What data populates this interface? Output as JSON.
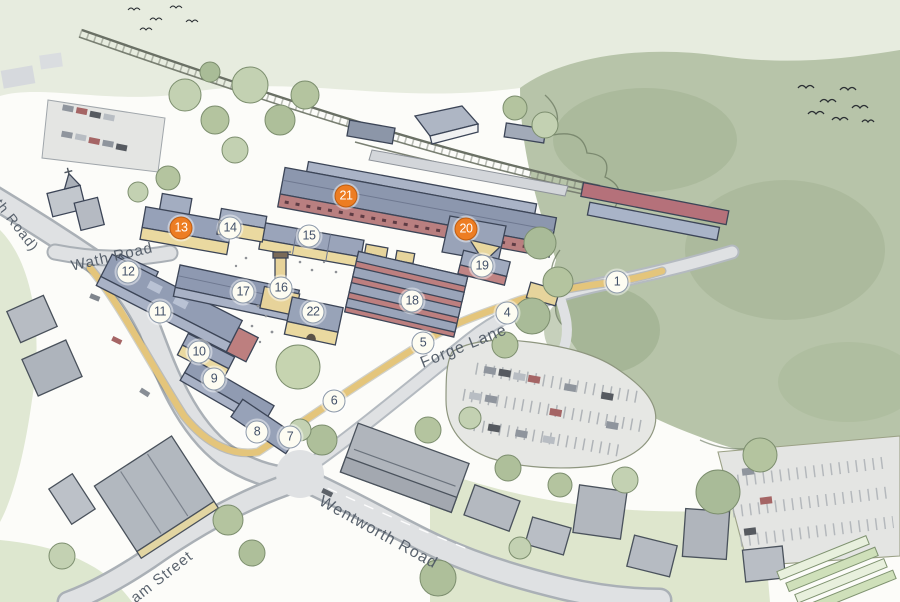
{
  "illustration": {
    "kind": "aerial illustrative masterplan",
    "colors": {
      "marker_orange": "#ED7D23",
      "marker_white_fill": "#FDFCF2",
      "marker_ring": "#8C99AA",
      "marker_number": "#44526A",
      "roof_slate_blue": "#99A4BA",
      "wall_cream": "#EAD9A0",
      "brick_red": "#BD7F7F",
      "road_gray": "#DFE1E3",
      "path_yellow": "#E4C57B",
      "woodland_green": "#B7C4A9",
      "label_text": "#4D5763"
    }
  },
  "markers": [
    {
      "number": "1",
      "x": 617,
      "y": 282,
      "variant": "white"
    },
    {
      "number": "4",
      "x": 507,
      "y": 313,
      "variant": "white"
    },
    {
      "number": "5",
      "x": 423,
      "y": 343,
      "variant": "white"
    },
    {
      "number": "6",
      "x": 334,
      "y": 401,
      "variant": "white"
    },
    {
      "number": "7",
      "x": 290,
      "y": 437,
      "variant": "white"
    },
    {
      "number": "8",
      "x": 257,
      "y": 432,
      "variant": "white"
    },
    {
      "number": "9",
      "x": 214,
      "y": 379,
      "variant": "white"
    },
    {
      "number": "10",
      "x": 199,
      "y": 352,
      "variant": "white"
    },
    {
      "number": "11",
      "x": 160,
      "y": 312,
      "variant": "white"
    },
    {
      "number": "12",
      "x": 128,
      "y": 272,
      "variant": "white"
    },
    {
      "number": "13",
      "x": 181,
      "y": 228,
      "variant": "orange"
    },
    {
      "number": "14",
      "x": 230,
      "y": 228,
      "variant": "white"
    },
    {
      "number": "15",
      "x": 309,
      "y": 236,
      "variant": "white"
    },
    {
      "number": "16",
      "x": 281,
      "y": 288,
      "variant": "white"
    },
    {
      "number": "17",
      "x": 243,
      "y": 292,
      "variant": "white"
    },
    {
      "number": "18",
      "x": 412,
      "y": 301,
      "variant": "white"
    },
    {
      "number": "19",
      "x": 482,
      "y": 266,
      "variant": "white"
    },
    {
      "number": "20",
      "x": 466,
      "y": 229,
      "variant": "orange"
    },
    {
      "number": "21",
      "x": 346,
      "y": 196,
      "variant": "orange"
    },
    {
      "number": "22",
      "x": 313,
      "y": 312,
      "variant": "white"
    }
  ],
  "road_labels": [
    {
      "text": "Wath Road",
      "x": 112,
      "y": 257,
      "rotation": -13,
      "size": 15
    },
    {
      "text": "th Road)",
      "x": 17,
      "y": 225,
      "rotation": 52,
      "size": 14
    },
    {
      "text": "Forge Lane",
      "x": 464,
      "y": 347,
      "rotation": -22,
      "size": 16
    },
    {
      "text": "Wentworth Road",
      "x": 378,
      "y": 533,
      "rotation": 29,
      "size": 16
    },
    {
      "text": "am Street",
      "x": 162,
      "y": 577,
      "rotation": -38,
      "size": 15
    }
  ]
}
